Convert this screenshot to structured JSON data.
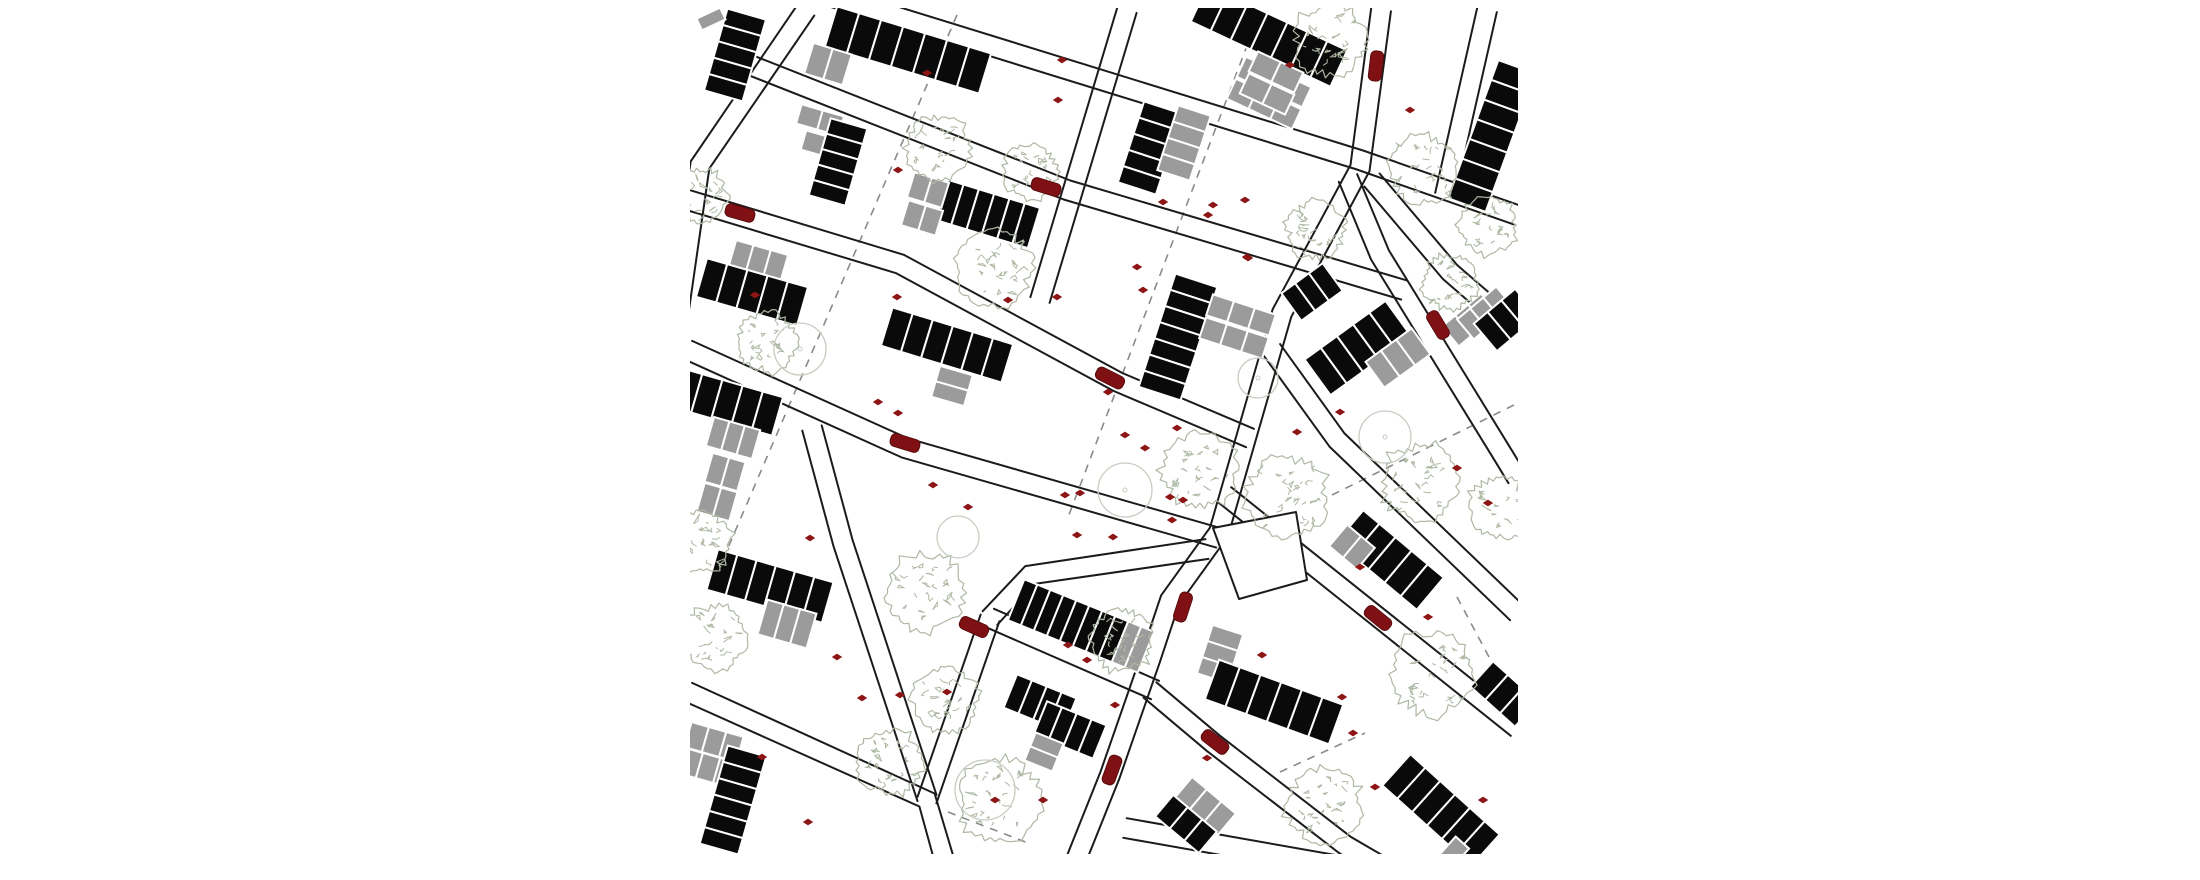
{
  "document": {
    "type": "architectural-site-plan",
    "title": "",
    "canvas": {
      "width": 2200,
      "height": 880,
      "background": "#ffffff"
    }
  },
  "map": {
    "clip": {
      "x": 690,
      "y": 8,
      "width": 828,
      "height": 846
    },
    "colors": {
      "street": "#1b1b1b",
      "building_black": "#0a0a0a",
      "building_gray": "#9b9b9b",
      "cell_gap": "#ffffff",
      "tree_sketch": "#aeb9a4",
      "tree_circle": "#c7cdc1",
      "car_fill": "#7f1114",
      "car_stroke": "#5c0b0d",
      "marker": "#8e1515",
      "dashed": "#8a8a8a"
    },
    "street_style": {
      "corridor_width": 20,
      "line_width": 2
    },
    "streets": [
      {
        "name": "upper-main-street",
        "pts": [
          [
            810,
            -10
          ],
          [
            1360,
            160
          ],
          [
            1517,
            215
          ]
        ]
      },
      {
        "name": "second-street",
        "pts": [
          [
            750,
            65
          ],
          [
            1067,
            190
          ],
          [
            1404,
            290
          ]
        ]
      },
      {
        "name": "third-street",
        "pts": [
          [
            688,
            200
          ],
          [
            900,
            264
          ],
          [
            1118,
            382
          ],
          [
            1250,
            438
          ]
        ]
      },
      {
        "name": "mid-street",
        "pts": [
          [
            688,
            350
          ],
          [
            905,
            448
          ],
          [
            1219,
            538
          ]
        ]
      },
      {
        "name": "lower-left-street",
        "pts": [
          [
            688,
            692
          ],
          [
            927,
            800
          ],
          [
            950,
            880
          ]
        ]
      },
      {
        "name": "connector-steep",
        "pts": [
          [
            927,
            800
          ],
          [
            990,
            618
          ]
        ]
      },
      {
        "name": "connector-east",
        "pts": [
          [
            990,
            618
          ],
          [
            1155,
            690
          ]
        ]
      },
      {
        "name": "connector-to-island",
        "pts": [
          [
            990,
            618
          ],
          [
            1030,
            575
          ],
          [
            1207,
            549
          ]
        ]
      },
      {
        "name": "vertical-street-west",
        "pts": [
          [
            806,
            10
          ],
          [
            700,
            165
          ],
          [
            676,
            330
          ]
        ]
      },
      {
        "name": "vertical-street-center",
        "pts": [
          [
            1127,
            10
          ],
          [
            1040,
            300
          ]
        ]
      },
      {
        "name": "seam-street",
        "pts": [
          [
            1381,
            10
          ],
          [
            1360,
            168
          ],
          [
            1282,
            313
          ],
          [
            1219,
            532
          ],
          [
            1170,
            600
          ],
          [
            1150,
            660
          ],
          [
            1110,
            775
          ],
          [
            1068,
            880
          ]
        ]
      },
      {
        "name": "vertical-street-left-lower",
        "pts": [
          [
            812,
            428
          ],
          [
            843,
            543
          ],
          [
            927,
            798
          ]
        ]
      },
      {
        "name": "southeast-branch",
        "pts": [
          [
            1150,
            690
          ],
          [
            1213,
            743
          ],
          [
            1345,
            845
          ],
          [
            1405,
            880
          ]
        ]
      },
      {
        "name": "northeast-corner-street",
        "pts": [
          [
            1487,
            10
          ],
          [
            1445,
            195
          ]
        ]
      },
      {
        "name": "northeast-diagonal",
        "pts": [
          [
            1372,
            180
          ],
          [
            1450,
            272
          ],
          [
            1517,
            330
          ]
        ]
      },
      {
        "name": "east-steep-diagonal",
        "pts": [
          [
            1348,
            178
          ],
          [
            1380,
            255
          ],
          [
            1503,
            455
          ],
          [
            1517,
            478
          ]
        ]
      },
      {
        "name": "east-long-diagonal-1",
        "pts": [
          [
            1272,
            350
          ],
          [
            1337,
            440
          ],
          [
            1517,
            613
          ]
        ]
      },
      {
        "name": "east-long-diagonal-2",
        "pts": [
          [
            1225,
            495
          ],
          [
            1517,
            728
          ]
        ]
      },
      {
        "name": "bottom-right-street",
        "pts": [
          [
            1125,
            828
          ],
          [
            1420,
            880
          ]
        ]
      }
    ],
    "island": {
      "name": "street-island",
      "pts": [
        [
          1213,
          528
        ],
        [
          1296,
          512
        ],
        [
          1307,
          580
        ],
        [
          1239,
          599
        ]
      ]
    },
    "dashed_lines": [
      {
        "pts": [
          [
            957,
            15
          ],
          [
            712,
            585
          ]
        ]
      },
      {
        "pts": [
          [
            1253,
            30
          ],
          [
            1067,
            520
          ]
        ]
      },
      {
        "pts": [
          [
            1332,
            495
          ],
          [
            1518,
            403
          ]
        ]
      },
      {
        "pts": [
          [
            1457,
            597
          ],
          [
            1513,
            702
          ]
        ]
      },
      {
        "pts": [
          [
            1280,
            772
          ],
          [
            1365,
            733
          ]
        ]
      },
      {
        "pts": [
          [
            948,
            812
          ],
          [
            1028,
            843
          ]
        ]
      }
    ],
    "buildings": [
      {
        "x": 735,
        "y": 55,
        "a": 106,
        "cw": 17,
        "cd": 40,
        "cells": "bbbbb"
      },
      {
        "x": 711,
        "y": 19,
        "a": -25,
        "cw": 26,
        "cd": 13,
        "cells": "g"
      },
      {
        "x": 908,
        "y": 50,
        "a": 17,
        "cw": 23,
        "cd": 42,
        "cells": "bbbbbbb"
      },
      {
        "x": 828,
        "y": 64,
        "a": 17,
        "cw": 20,
        "cd": 32,
        "cells": "gg"
      },
      {
        "x": 1269,
        "y": 36,
        "a": 25,
        "cw": 22,
        "cd": 40,
        "cells": "bbbbbbb"
      },
      {
        "x": 1274,
        "y": 82,
        "a": 25,
        "cw": 24,
        "cd": 22,
        "cells": "ggg"
      },
      {
        "x": 1264,
        "y": 104,
        "a": 25,
        "cw": 24,
        "cd": 22,
        "cells": "ggg"
      },
      {
        "x": 1492,
        "y": 136,
        "a": 110,
        "cw": 21,
        "cd": 40,
        "cells": "bbbbbbb"
      },
      {
        "x": 820,
        "y": 120,
        "a": 16,
        "cw": 22,
        "cd": 20,
        "cells": "gg"
      },
      {
        "x": 814,
        "y": 143,
        "a": 16,
        "cw": 22,
        "cd": 20,
        "cells": "g"
      },
      {
        "x": 838,
        "y": 162,
        "a": 106,
        "cw": 16,
        "cd": 38,
        "cells": "bbbbb"
      },
      {
        "x": 988,
        "y": 214,
        "a": 17,
        "cw": 16,
        "cd": 42,
        "cells": "bbbbbb"
      },
      {
        "x": 928,
        "y": 190,
        "a": 17,
        "cw": 18,
        "cd": 26,
        "cells": "gg"
      },
      {
        "x": 922,
        "y": 218,
        "a": 17,
        "cw": 18,
        "cd": 26,
        "cells": "gg"
      },
      {
        "x": 758,
        "y": 262,
        "a": 16,
        "cw": 18,
        "cd": 30,
        "cells": "ggg"
      },
      {
        "x": 752,
        "y": 292,
        "a": 16,
        "cw": 21,
        "cd": 40,
        "cells": "bbbbb"
      },
      {
        "x": 1150,
        "y": 148,
        "a": 108,
        "cw": 17,
        "cd": 40,
        "cells": "bbbbb"
      },
      {
        "x": 1184,
        "y": 143,
        "a": 108,
        "cw": 17,
        "cd": 34,
        "cells": "gggg"
      },
      {
        "x": 1178,
        "y": 337,
        "a": 108,
        "cw": 17,
        "cd": 44,
        "cells": "bbbbbbb"
      },
      {
        "x": 1241,
        "y": 315,
        "a": 18,
        "cw": 22,
        "cd": 22,
        "cells": "ggg"
      },
      {
        "x": 1234,
        "y": 338,
        "a": 18,
        "cw": 22,
        "cd": 22,
        "cells": "ggg"
      },
      {
        "x": 947,
        "y": 345,
        "a": 17,
        "cw": 21,
        "cd": 40,
        "cells": "bbbbbb"
      },
      {
        "x": 952,
        "y": 386,
        "a": 106,
        "cw": 16,
        "cd": 34,
        "cells": "gg"
      },
      {
        "x": 727,
        "y": 402,
        "a": 16,
        "cw": 21,
        "cd": 40,
        "cells": "bbbbb"
      },
      {
        "x": 733,
        "y": 438,
        "a": 16,
        "cw": 16,
        "cd": 30,
        "cells": "ggg"
      },
      {
        "x": 725,
        "y": 472,
        "a": 16,
        "cw": 17,
        "cd": 30,
        "cells": "gg"
      },
      {
        "x": 717,
        "y": 502,
        "a": 16,
        "cw": 17,
        "cd": 30,
        "cells": "gg"
      },
      {
        "x": 770,
        "y": 586,
        "a": 16,
        "cw": 20,
        "cd": 42,
        "cells": "bbbbbb"
      },
      {
        "x": 787,
        "y": 624,
        "a": 16,
        "cw": 17,
        "cd": 36,
        "cells": "ggg"
      },
      {
        "x": 714,
        "y": 742,
        "a": 16,
        "cw": 18,
        "cd": 26,
        "cells": "ggg"
      },
      {
        "x": 708,
        "y": 768,
        "a": 16,
        "cw": 18,
        "cd": 26,
        "cells": "ggg"
      },
      {
        "x": 733,
        "y": 800,
        "a": 106,
        "cw": 17,
        "cd": 40,
        "cells": "bbbbbb"
      },
      {
        "x": 1081,
        "y": 626,
        "a": 22,
        "cw": 14,
        "cd": 44,
        "cells": "bbbbbbbbgg"
      },
      {
        "x": 1040,
        "y": 703,
        "a": 22,
        "cw": 16,
        "cd": 36,
        "cells": "bbbb"
      },
      {
        "x": 1070,
        "y": 730,
        "a": 22,
        "cw": 16,
        "cd": 36,
        "cells": "bbbb"
      },
      {
        "x": 1044,
        "y": 752,
        "a": 112,
        "cw": 15,
        "cd": 30,
        "cells": "gg"
      },
      {
        "x": 1220,
        "y": 654,
        "a": 108,
        "cw": 17,
        "cd": 32,
        "cells": "ggg"
      },
      {
        "x": 1274,
        "y": 702,
        "a": 20,
        "cw": 22,
        "cd": 42,
        "cells": "bbbbbb"
      },
      {
        "x": 1390,
        "y": 560,
        "a": 40,
        "cw": 21,
        "cd": 42,
        "cells": "bbbbb"
      },
      {
        "x": 1352,
        "y": 547,
        "a": 40,
        "cw": 18,
        "cd": 28,
        "cells": "gg"
      },
      {
        "x": 1441,
        "y": 810,
        "a": 42,
        "cw": 20,
        "cd": 42,
        "cells": "bbbbbb"
      },
      {
        "x": 1453,
        "y": 853,
        "a": 42,
        "cw": 18,
        "cd": 28,
        "cells": "g"
      },
      {
        "x": 1205,
        "y": 806,
        "a": 40,
        "cw": 19,
        "cd": 28,
        "cells": "ggg"
      },
      {
        "x": 1186,
        "y": 824,
        "a": 40,
        "cw": 19,
        "cd": 28,
        "cells": "bbb"
      },
      {
        "x": 1276,
        "y": 72,
        "a": 25,
        "cw": 25,
        "cd": 22,
        "cells": "gg"
      },
      {
        "x": 1267,
        "y": 94,
        "a": 25,
        "cw": 25,
        "cd": 22,
        "cells": "gg"
      },
      {
        "x": 1358,
        "y": 348,
        "a": -36,
        "cw": 20,
        "cd": 44,
        "cells": "bbbbb"
      },
      {
        "x": 1398,
        "y": 358,
        "a": -36,
        "cw": 19,
        "cd": 32,
        "cells": "ggg"
      },
      {
        "x": 1312,
        "y": 292,
        "a": -36,
        "cw": 17,
        "cd": 34,
        "cells": "bbb"
      },
      {
        "x": 1470,
        "y": 320,
        "a": 140,
        "cw": 17,
        "cd": 26,
        "cells": "ggg"
      },
      {
        "x": 1485,
        "y": 313,
        "a": 140,
        "cw": 17,
        "cd": 26,
        "cells": "ggg"
      },
      {
        "x": 1506,
        "y": 320,
        "a": 140,
        "cw": 18,
        "cd": 36,
        "cells": "bbb"
      },
      {
        "x": 1504,
        "y": 694,
        "a": 42,
        "cw": 20,
        "cd": 34,
        "cells": "bbb"
      }
    ],
    "trees_sketch": [
      [
        938,
        148,
        36
      ],
      [
        1030,
        172,
        30
      ],
      [
        1330,
        40,
        40
      ],
      [
        1316,
        230,
        32
      ],
      [
        1424,
        170,
        38
      ],
      [
        1488,
        225,
        32
      ],
      [
        1450,
        282,
        30
      ],
      [
        700,
        196,
        30
      ],
      [
        768,
        342,
        33
      ],
      [
        993,
        268,
        43
      ],
      [
        1200,
        470,
        42
      ],
      [
        1287,
        497,
        45
      ],
      [
        925,
        593,
        43
      ],
      [
        715,
        638,
        36
      ],
      [
        890,
        762,
        36
      ],
      [
        1000,
        800,
        46
      ],
      [
        945,
        700,
        36
      ],
      [
        1122,
        640,
        34
      ],
      [
        1325,
        806,
        42
      ],
      [
        1432,
        674,
        46
      ],
      [
        1420,
        482,
        42
      ],
      [
        1500,
        508,
        34
      ],
      [
        700,
        542,
        34
      ]
    ],
    "trees_circle": [
      {
        "x": 1125,
        "y": 490,
        "r": 27,
        "dot": true
      },
      {
        "x": 800,
        "y": 349,
        "r": 26,
        "dot": true
      },
      {
        "x": 958,
        "y": 537,
        "r": 21,
        "dot": false
      },
      {
        "x": 1258,
        "y": 378,
        "r": 20,
        "dot": true
      },
      {
        "x": 1385,
        "y": 437,
        "r": 26,
        "dot": true
      },
      {
        "x": 985,
        "y": 790,
        "r": 30,
        "dot": false
      }
    ],
    "cars": [
      {
        "x": 740,
        "y": 213,
        "a": 16
      },
      {
        "x": 1046,
        "y": 187,
        "a": 17
      },
      {
        "x": 1376,
        "y": 66,
        "a": 97
      },
      {
        "x": 905,
        "y": 443,
        "a": 17
      },
      {
        "x": 974,
        "y": 627,
        "a": 24
      },
      {
        "x": 1183,
        "y": 607,
        "a": 108
      },
      {
        "x": 1215,
        "y": 742,
        "a": 38
      },
      {
        "x": 1112,
        "y": 770,
        "a": 110
      },
      {
        "x": 1378,
        "y": 618,
        "a": 39
      },
      {
        "x": 1110,
        "y": 378,
        "a": 27
      },
      {
        "x": 1438,
        "y": 325,
        "a": 59
      }
    ],
    "car_size": {
      "length": 30,
      "width": 13
    },
    "markers": [
      [
        927,
        73
      ],
      [
        898,
        170
      ],
      [
        1062,
        60
      ],
      [
        1058,
        100
      ],
      [
        755,
        295
      ],
      [
        897,
        297
      ],
      [
        1008,
        300
      ],
      [
        1057,
        297
      ],
      [
        878,
        402
      ],
      [
        898,
        413
      ],
      [
        1163,
        202
      ],
      [
        1213,
        205
      ],
      [
        1208,
        215
      ],
      [
        1245,
        200
      ],
      [
        1290,
        65
      ],
      [
        1137,
        267
      ],
      [
        1143,
        290
      ],
      [
        1248,
        258
      ],
      [
        1177,
        428
      ],
      [
        1125,
        435
      ],
      [
        1145,
        448
      ],
      [
        1065,
        495
      ],
      [
        1080,
        493
      ],
      [
        1170,
        497
      ],
      [
        1183,
        500
      ],
      [
        1172,
        520
      ],
      [
        1077,
        535
      ],
      [
        1297,
        432
      ],
      [
        1340,
        412
      ],
      [
        810,
        538
      ],
      [
        933,
        485
      ],
      [
        968,
        507
      ],
      [
        837,
        657
      ],
      [
        862,
        698
      ],
      [
        900,
        695
      ],
      [
        947,
        692
      ],
      [
        1043,
        800
      ],
      [
        995,
        800
      ],
      [
        1113,
        537
      ],
      [
        808,
        822
      ],
      [
        1068,
        645
      ],
      [
        1087,
        660
      ],
      [
        1115,
        705
      ],
      [
        1207,
        758
      ],
      [
        1262,
        655
      ],
      [
        1457,
        468
      ],
      [
        1428,
        617
      ],
      [
        1342,
        697
      ],
      [
        1353,
        733
      ],
      [
        1375,
        787
      ],
      [
        1483,
        800
      ],
      [
        1360,
        567
      ],
      [
        1410,
        110
      ],
      [
        1108,
        392
      ],
      [
        762,
        757
      ],
      [
        1247,
        257
      ],
      [
        1488,
        503
      ]
    ]
  }
}
